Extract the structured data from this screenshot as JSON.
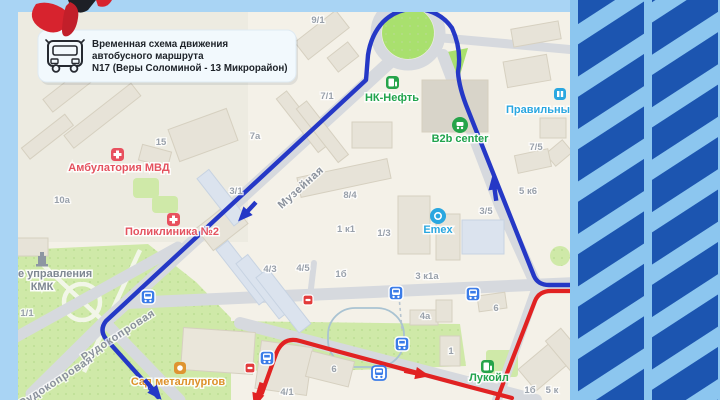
{
  "callout": {
    "line1": "Временная схема движения",
    "line2": "автобусного маршрута",
    "line3": "N17 (Веры Соломиной - 13 Микрорайон)"
  },
  "map": {
    "streets": {
      "muzeynaya": "Музейная",
      "rudokoprovaya": "Рудокопровая"
    },
    "poi": {
      "nk_neft": "НК-Нефть",
      "b2b": "B2b center",
      "pravilny": "Правильны",
      "emex": "Emex",
      "ambulatoria": "Амбулатория МВД",
      "poliklinika": "Поликлиника №2",
      "lukoil": "Лукойл",
      "sad_metallurgov": "Сад металлургов",
      "kmk_line1": "е управления",
      "kmk_line2": "КМК"
    },
    "building_numbers": [
      "9/1",
      "7/1",
      "7а",
      "15",
      "10а",
      "3/1",
      "8/4",
      "1 к1",
      "1/3",
      "4/3",
      "4/5",
      "1б",
      "3 к1а",
      "5 к6",
      "7/5",
      "3/5",
      "4а",
      "6",
      "1",
      "6",
      "4/1",
      "1/1",
      "1б",
      "5 к"
    ]
  },
  "icons": {
    "callout": "bus-icon",
    "stops": "bus-stop-icon",
    "closed_stops": "closed-stop-icon",
    "fuel": "fuel-station-icon",
    "medical": "medical-cross-icon",
    "shopping": "shopping-cart-icon",
    "emex": "emex-brand-icon",
    "attraction": "attraction-icon",
    "monument": "monument-icon",
    "mascot": "red-mascot-logo"
  },
  "colors": {
    "frame": "#a9d4f4",
    "stripe_bg": "#8cc6ef",
    "stripe_dark": "#1c55b0",
    "map_bg": "#f4f1e8",
    "park": "#cfe9a8",
    "road": "#d6d9de",
    "route_blue": "#2538c6",
    "route_red": "#e12222",
    "stop_blue": "#3b7ce8"
  }
}
